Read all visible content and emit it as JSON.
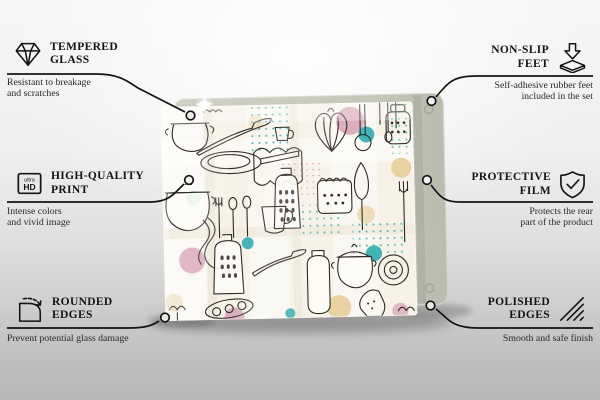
{
  "callouts": {
    "tempered_glass": {
      "icon": "diamond-icon",
      "title": [
        "TEMPERED",
        "GLASS"
      ],
      "desc": [
        "Resistant to breakage",
        "and scratches"
      ]
    },
    "high_quality_print": {
      "icon": "ultra-hd-icon",
      "title": [
        "HIGH-QUALITY",
        "PRINT"
      ],
      "desc": [
        "Intense colors",
        "and vivid image"
      ],
      "icon_label_top": "ultra",
      "icon_label_bottom": "HD"
    },
    "rounded_edges": {
      "icon": "rounded-corner-icon",
      "title": [
        "ROUNDED",
        "EDGES"
      ],
      "desc": [
        "Prevent potential glass damage"
      ]
    },
    "non_slip_feet": {
      "icon": "arrow-onto-pad-icon",
      "title": [
        "NON-SLIP",
        "FEET"
      ],
      "desc": [
        "Self-adhesive rubber feet",
        "included in the set"
      ]
    },
    "protective_film": {
      "icon": "shield-check-icon",
      "title": [
        "PROTECTIVE",
        "FILM"
      ],
      "desc": [
        "Protects the rear",
        "part of the product"
      ]
    },
    "polished_edges": {
      "icon": "hatch-lines-icon",
      "title": [
        "POLISHED",
        "EDGES"
      ],
      "desc": [
        "Smooth and safe finish"
      ]
    }
  },
  "product": {
    "board_color": "#c9cabc",
    "line_color": "#141414",
    "pattern_colors": {
      "cream": "#f6f2e8",
      "pink": "#dcadbc",
      "teal": "#43b3b6",
      "tan": "#e9d2a2",
      "doodle": "#2e2b27"
    }
  }
}
